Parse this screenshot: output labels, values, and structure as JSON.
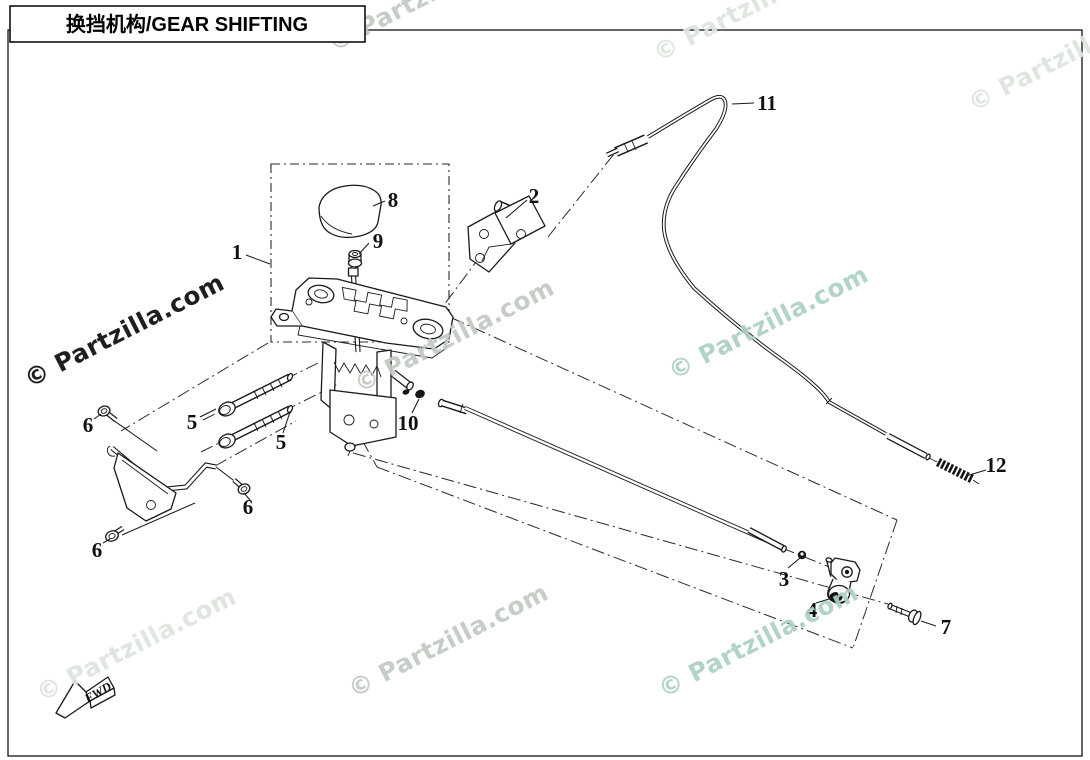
{
  "title_box": {
    "text": "换挡机构/GEAR SHIFTING"
  },
  "watermark": {
    "text": "© Partzilla.com"
  },
  "colors": {
    "line": "#1a1a1a",
    "watermark_dark": "#1e1e1e",
    "watermark_gray": "#c2c9c2",
    "watermark_light": "#dde4dd",
    "watermark_teal": "#abd0c6"
  },
  "callouts": {
    "n1": "1",
    "n2": "2",
    "n3": "3",
    "n4": "4",
    "n5a": "5",
    "n5b": "5",
    "n6a": "6",
    "n6b": "6",
    "n6c": "6",
    "n7": "7",
    "n8": "8",
    "n9": "9",
    "n10": "10",
    "n11": "11",
    "n12": "12"
  },
  "fwd_marker": {
    "text": "FWD"
  }
}
